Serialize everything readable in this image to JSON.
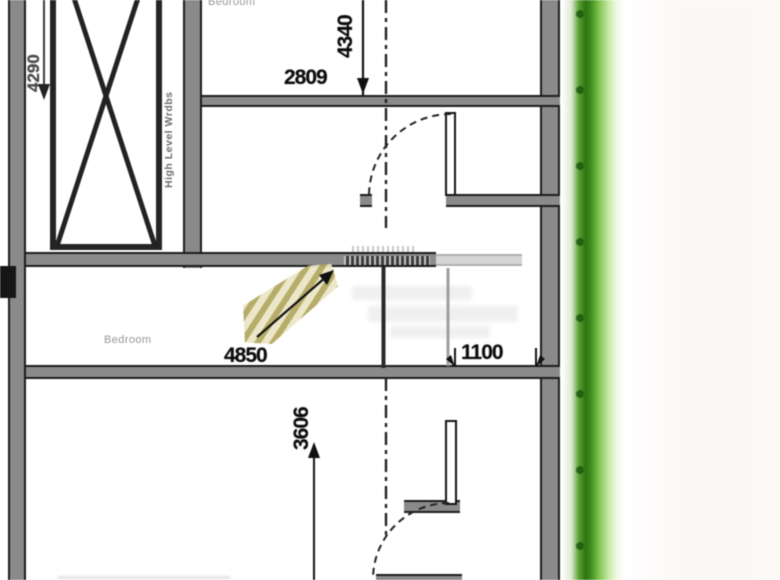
{
  "labels": {
    "bedroom_top": "Bedroom",
    "bedroom_mid": "Bedroom",
    "high_level_wardrobes": "High Level Wrdbs"
  },
  "dimensions": {
    "left_height": "4290",
    "top_room_height": "4340",
    "top_room_width": "2809",
    "mid_room_width": "4850",
    "right_opening": "1100",
    "bottom_room_height": "3606"
  },
  "colors": {
    "wall_fill": "#8a8a8a",
    "wall_edge": "#1c1c1c",
    "line": "#1b1b1b",
    "dim_text": "#0c0c0c",
    "label_text": "#8c8c8c",
    "green_band": "#3f8f1f",
    "green_dark": "#2e7413",
    "stair_tan": "#b3a963",
    "stair_tan_light": "#ebe6c5"
  }
}
